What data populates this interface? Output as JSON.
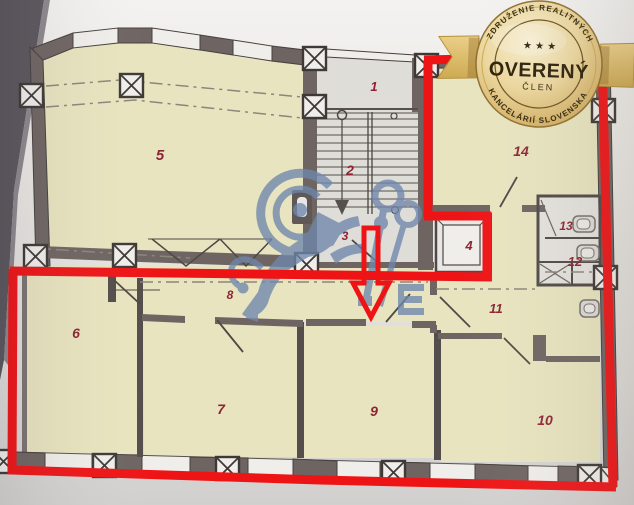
{
  "badge": {
    "arc_top": "ZDRUŽENIE REALITNÝCH",
    "arc_bottom": "KANCELÁRIÍ SLOVENSKA",
    "stars": "★ ★ ★",
    "title": "OVERENÝ",
    "subtitle": "ČLEN",
    "colors": {
      "gold_light": "#f7eecd",
      "gold": "#d9b972",
      "gold_dark": "#a8812f",
      "ribbon": "#e3c77c",
      "text": "#2f2410"
    }
  },
  "floor_plan": {
    "rooms": [
      {
        "label": "1"
      },
      {
        "label": "2"
      },
      {
        "label": "3"
      },
      {
        "label": "4"
      },
      {
        "label": "5"
      },
      {
        "label": "6"
      },
      {
        "label": "7"
      },
      {
        "label": "8"
      },
      {
        "label": "9"
      },
      {
        "label": "10"
      },
      {
        "label": "11"
      },
      {
        "label": "12"
      },
      {
        "label": "13"
      },
      {
        "label": "14"
      }
    ],
    "label_color": "#8e2433",
    "room_fill": "#e8e4bf",
    "wall_color": "#6e6562",
    "annotation_color": "#ee1416"
  },
  "watermark": {
    "icon": "lion-with-crossed-keys-watermark",
    "color": "#6f87ac"
  }
}
